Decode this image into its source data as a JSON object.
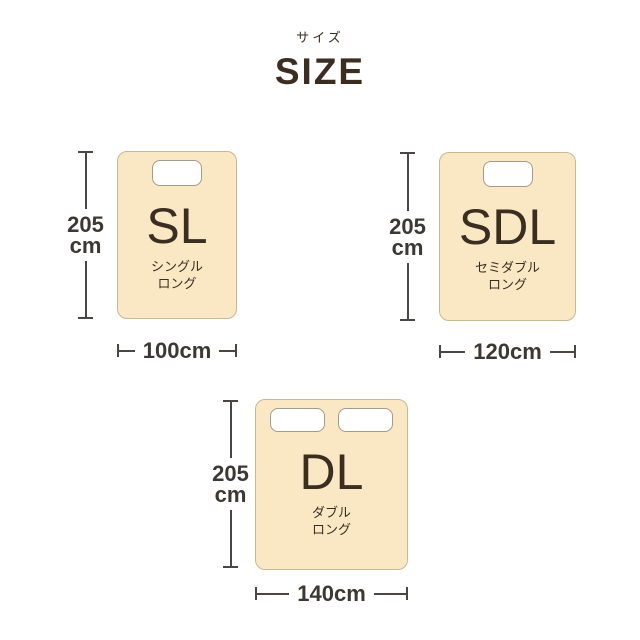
{
  "header": {
    "subtitle_ja": "サイズ",
    "title": "SIZE"
  },
  "colors": {
    "mattress_fill": "#FAE7C4",
    "mattress_border": "#C9B894",
    "pillow_fill": "#FFFFFF",
    "pillow_border": "#A49B8C",
    "text_dark": "#3B2E20",
    "dim_line": "#4A4643",
    "dim_text": "#3C3834"
  },
  "sizes": [
    {
      "abbr": "SL",
      "name_line1": "シングル",
      "name_line2": "ロング",
      "height_value": "205",
      "height_unit": "cm",
      "width_label": "100cm",
      "pillow_count": 1
    },
    {
      "abbr": "SDL",
      "name_line1": "セミダブル",
      "name_line2": "ロング",
      "height_value": "205",
      "height_unit": "cm",
      "width_label": "120cm",
      "pillow_count": 1
    },
    {
      "abbr": "DL",
      "name_line1": "ダブル",
      "name_line2": "ロング",
      "height_value": "205",
      "height_unit": "cm",
      "width_label": "140cm",
      "pillow_count": 2
    }
  ]
}
